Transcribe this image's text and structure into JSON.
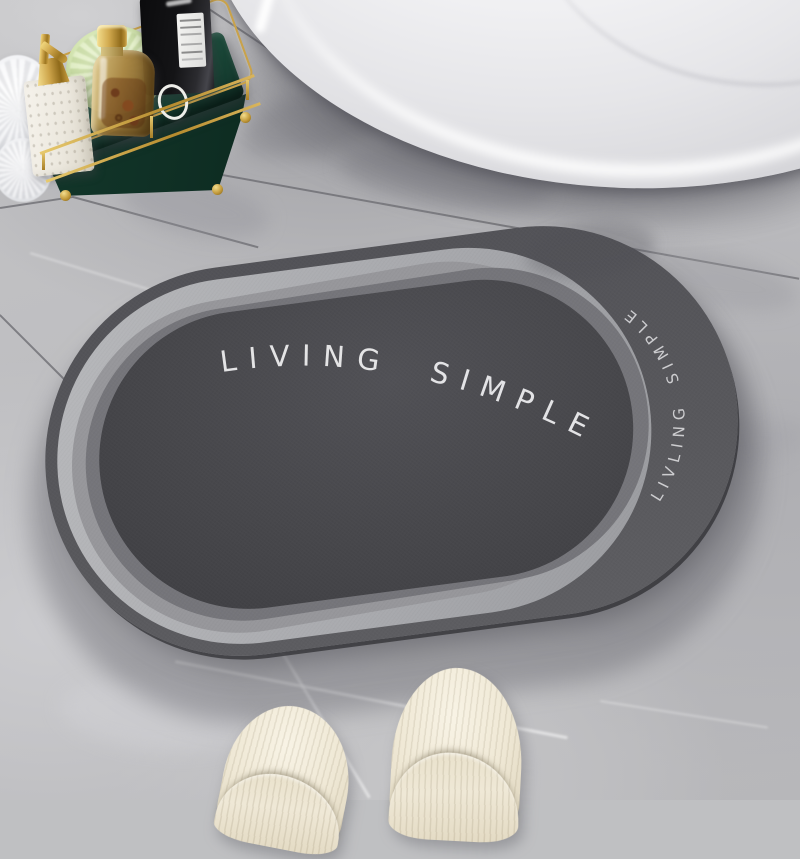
{
  "mat": {
    "center_text": "LIVING SIMPLE",
    "edge_text": "LIVLING SIMPLE",
    "colors": {
      "center": "#47474b",
      "mid_band_dark": "#75757a",
      "mid_band_light": "#97979b",
      "outer_ring_light": "#a9aaae",
      "base_band": "#58585c",
      "edge": "#1c1c1f",
      "text": "#ececee"
    }
  },
  "floor": {
    "base_color": "#bfc0c2",
    "grout_color": "#68686d",
    "vein_color": "#ffffff"
  },
  "bathtub": {
    "color": "#f5f5f7",
    "shadow_color": "#50505a"
  },
  "tray": {
    "frame_color": "#c9a24a",
    "base_color": "#1d4e3d"
  },
  "items": {
    "white_loofah_color": "#f0f1f4",
    "soap_bottle_color": "#ece8de",
    "pump_color": "#cda44a",
    "green_loofah_color": "#d5e6b2",
    "oil_bottle_color": "#a6823e",
    "oil_cap_color": "#d1a94e",
    "black_bottle_color": "#141416",
    "black_bottle_label_color": "#f4f4f2",
    "rope_color": "#eeeee9"
  },
  "slippers": {
    "color": "#efe8d5"
  }
}
